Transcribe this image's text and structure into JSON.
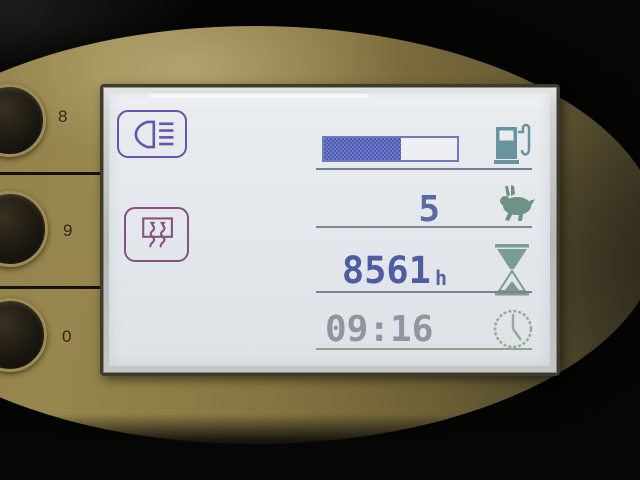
{
  "keypad": {
    "buttons": [
      {
        "label": "8"
      },
      {
        "label": "9"
      },
      {
        "label": "0"
      }
    ]
  },
  "display": {
    "indicators": {
      "headlight": {
        "icon": "headlight-icon",
        "active": true
      },
      "heater": {
        "icon": "heater-vent-icon",
        "active": true
      }
    },
    "fuel": {
      "icon": "fuel-pump-icon",
      "level_percent": 58
    },
    "speed_level": {
      "value": "5",
      "icon": "rabbit-icon"
    },
    "hour_meter": {
      "value": "8561",
      "unit": "h",
      "icon": "hourglass-icon"
    },
    "time": {
      "value": "09:16",
      "icon": "clock-icon"
    }
  },
  "colors": {
    "fuel_fill": "#5560b4",
    "fuel_border": "#6d7cb4",
    "digits_blue": "#4e5da2",
    "digits_gray": "#9096a1",
    "icon_teal": "#6a93a0",
    "icon_green": "#6f9287",
    "icon_hourglass": "#7b9c94",
    "icon_clock": "#96a89c",
    "indicator_purple": "#6257a8",
    "indicator_maroon": "#85517e",
    "panel_gold": "#8a7a44",
    "lcd_background": "#e7eaee"
  }
}
